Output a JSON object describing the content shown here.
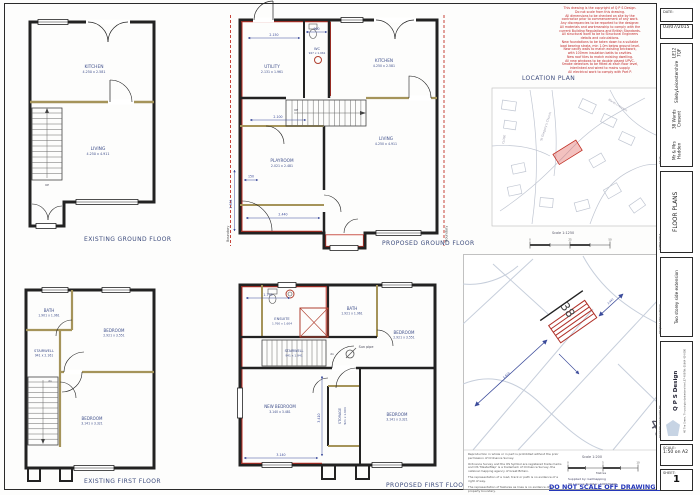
{
  "page": {
    "do_not_scale": "DO NOT SCALE OFF DRAWINGS."
  },
  "captions": {
    "existing_ground": "EXISTING GROUND FLOOR",
    "proposed_ground": "PROPOSED GROUND FLOOR",
    "existing_first": "EXISTING FIRST FLOOR",
    "proposed_first": "PROPOSED FIRST FLOOR"
  },
  "notes_red": [
    "This drawing is the copyright of Q P S Design.",
    "Do not scale from this drawing.",
    "All dimensions to be checked on site by the",
    "contractor prior to commencement of any work.",
    "Any discrepancies to be reported to the designer.",
    "All materials and workmanship to comply with the",
    "current Building Regulations and British Standards.",
    "All structural work to be to Structural Engineers",
    "details and calculations.",
    "New foundations to be taken down to a suitable",
    "load bearing strata, min 1.0m below ground level.",
    "New cavity walls to match existing brickwork,",
    "with 100mm insulation batts to cavities.",
    "New roof tiles to match existing dwelling.",
    "All new windows to be double glazed UPVC.",
    "Smoke detectors to be fitted at each floor level,",
    "interlinked and wired to mains supply.",
    "All electrical work to comply with Part P."
  ],
  "location_plan": {
    "title": "LOCATION PLAN",
    "scale_label": "Scale 1:1250",
    "church": "St Gregory's Church",
    "street": "Wards Crescent",
    "close": "CLOSE",
    "ticks": [
      "0",
      "25",
      "50"
    ]
  },
  "site_plan": {
    "plot": "38",
    "neighbour": "40",
    "scale_label": "Scale 1:200",
    "metres": "Metres",
    "dim_a": "5.810",
    "dim_b": "2.440",
    "supplied": "Supplied by: Getmapping",
    "licence": "OS Licence Number: 100020449",
    "ticks": [
      "0",
      "5",
      "10"
    ],
    "disclaimers": [
      "Reproduction in whole or in part is prohibited without the prior permission of Ordnance Survey.",
      "Ordnance Survey and the OS Symbol are registered trade marks and OS 'MasterMap' is a trademark of Ordnance Survey, the national mapping agency of Great Britain.",
      "The representation of a road, track or path is no evidence of a right of way.",
      "The representation of features as lines is no evidence of a property boundary."
    ]
  },
  "title_block": {
    "date_label": "DATE:",
    "date_value": "03/07/2015",
    "client_label": "Client",
    "client_lines": [
      "Mr & Mrs Hadden",
      "38 Wards Cresent",
      "Sileby",
      "Leicestershire",
      "LE12 7QF"
    ],
    "sheet_title_label": "SHEET TITLE",
    "sheet_title": "FLOOR PLANS",
    "project_label": "PROJECT DESCRIPTION",
    "project": "Two storey side extension",
    "producer_label": "DRAWING PRODUCED BY:",
    "producer": "Q P S Design",
    "producer_lines": [
      "40 The Green, Thrussington",
      "Leicestershire LE7 4UB",
      "Tel: 01664 424 000"
    ],
    "scale_label": "SCALE:",
    "scale_value": "1:50 on A2",
    "sheet_label": "SHEET:",
    "sheet_value": "1"
  },
  "plans": {
    "existing_ground": {
      "rooms": [
        {
          "name": "KITCHEN",
          "dims": "4.250 x 2.581"
        },
        {
          "name": "LIVING",
          "dims": "4.250 x 4.911"
        }
      ],
      "stair": "UP"
    },
    "proposed_ground": {
      "rooms": [
        {
          "name": "UTILITY",
          "dims": "2.131 x 1.961"
        },
        {
          "name": "WC",
          "dims": "947 x 1.961"
        },
        {
          "name": "KITCHEN",
          "dims": "4.250 x 2.581"
        },
        {
          "name": "PLAYROOM",
          "dims": "2.021 x 2.481"
        },
        {
          "name": "LIVING",
          "dims": "4.250 x 4.911"
        }
      ],
      "stair": "UP",
      "boundary": "Boundary",
      "dims": {
        "d1": "2.150",
        "d2": "900",
        "d3": "2.100",
        "d4": "150",
        "d5": "2.440",
        "d6": "1.804"
      }
    },
    "existing_first": {
      "rooms": [
        {
          "name": "BATH",
          "dims": "1.901 x 1.961"
        },
        {
          "name": "BEDROOM",
          "dims": "2.921 x 3.551"
        },
        {
          "name": "STAIRWELL",
          "dims": "941 x 2.161"
        },
        {
          "name": "BEDROOM",
          "dims": "3.141 x 3.321"
        }
      ],
      "stair": "dn"
    },
    "proposed_first": {
      "rooms": [
        {
          "name": "ENSUITE",
          "dims": "1.760 x 1.604"
        },
        {
          "name": "BATH",
          "dims": "1.921 x 1.961"
        },
        {
          "name": "BEDROOM",
          "dims": "2.921 x 3.551"
        },
        {
          "name": "STAIRWELL",
          "dims": "941 x 1.941"
        },
        {
          "name": "NEW BEDROOM",
          "dims": "3.140 x 3.481"
        },
        {
          "name": "STORAGE",
          "dims": "921 x 1.604"
        },
        {
          "name": "BEDROOM",
          "dims": "3.141 x 3.321"
        }
      ],
      "stair": "dn",
      "sun_pipe": "Sun pipe",
      "dims": {
        "d1": "1.770",
        "d2": "3.410",
        "d3": "3.140"
      }
    }
  }
}
